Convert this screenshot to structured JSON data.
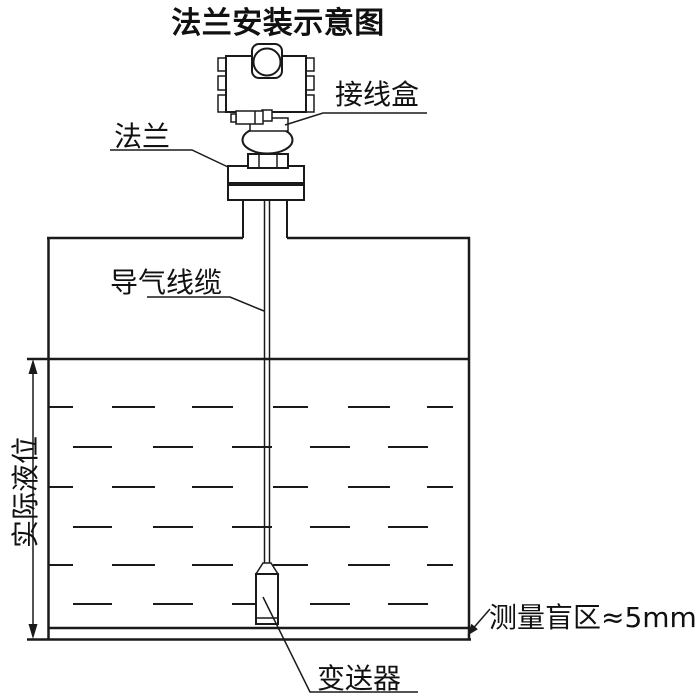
{
  "title": "法兰安装示意图",
  "labels": {
    "junction_box": "接线盒",
    "flange": "法兰",
    "air_cable": "导气线缆",
    "actual_level": "实际液位",
    "blind_zone": "测量盲区≈5mm",
    "transmitter": "变送器"
  },
  "colors": {
    "line": "#1a1a1a",
    "background": "#ffffff"
  }
}
